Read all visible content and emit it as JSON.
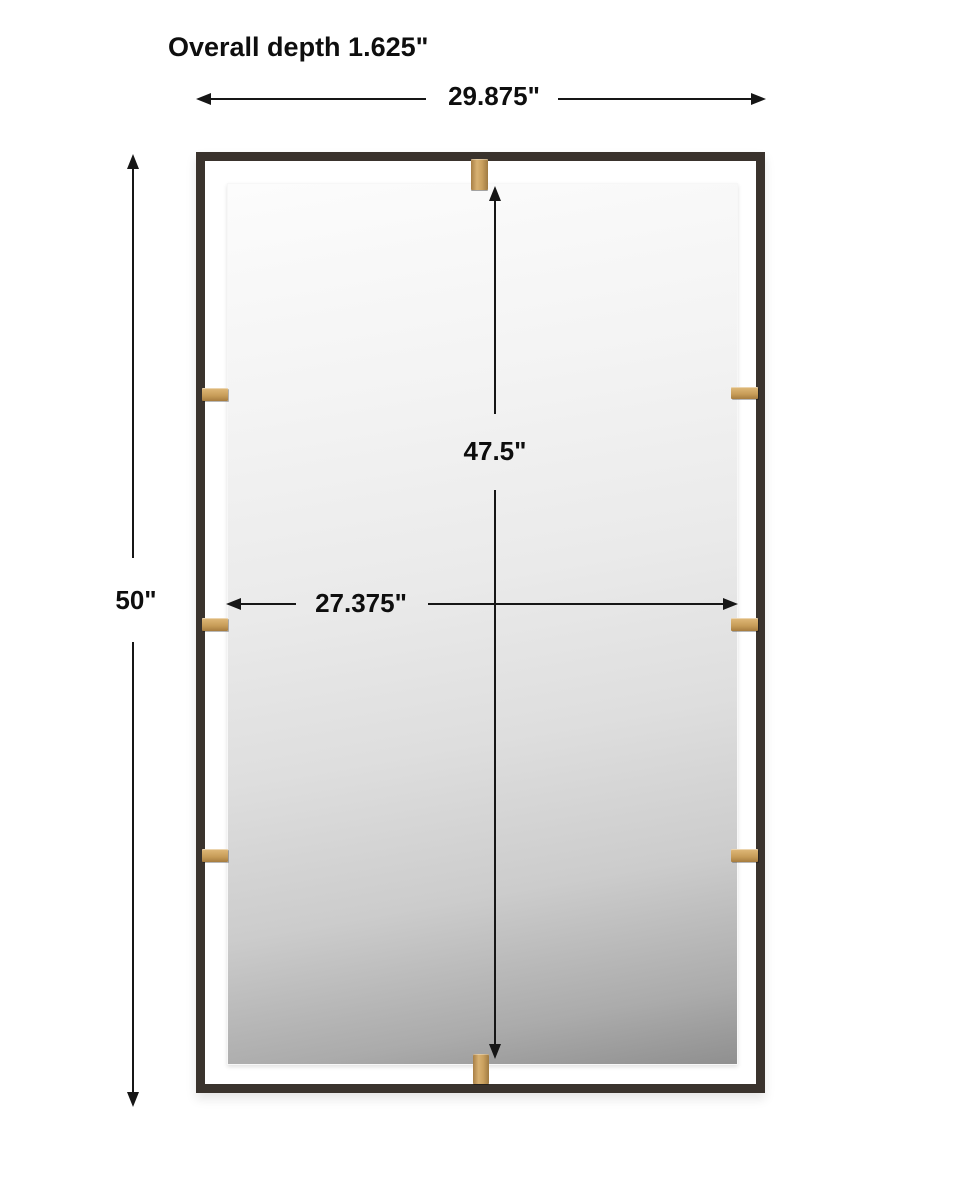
{
  "diagram": {
    "title": "Overall depth 1.625\"",
    "dimensions": {
      "overall_width": "29.875\"",
      "overall_height": "50\"",
      "mirror_height": "47.5\"",
      "mirror_width": "27.375\"",
      "overall_depth": "1.625\""
    },
    "product": {
      "description": "rectangular mirror with thin dark metal frame, floating beveled mirror and brass corner clips",
      "clip_count": 8
    },
    "colors": {
      "background": "#ffffff",
      "frame": "#3a332d",
      "clip_brass": "#c79c58",
      "arrow": "#161616",
      "label_text": "#0e0e0e",
      "glass_light": "#fcfcfc",
      "glass_dark": "#8f8f8f"
    }
  }
}
